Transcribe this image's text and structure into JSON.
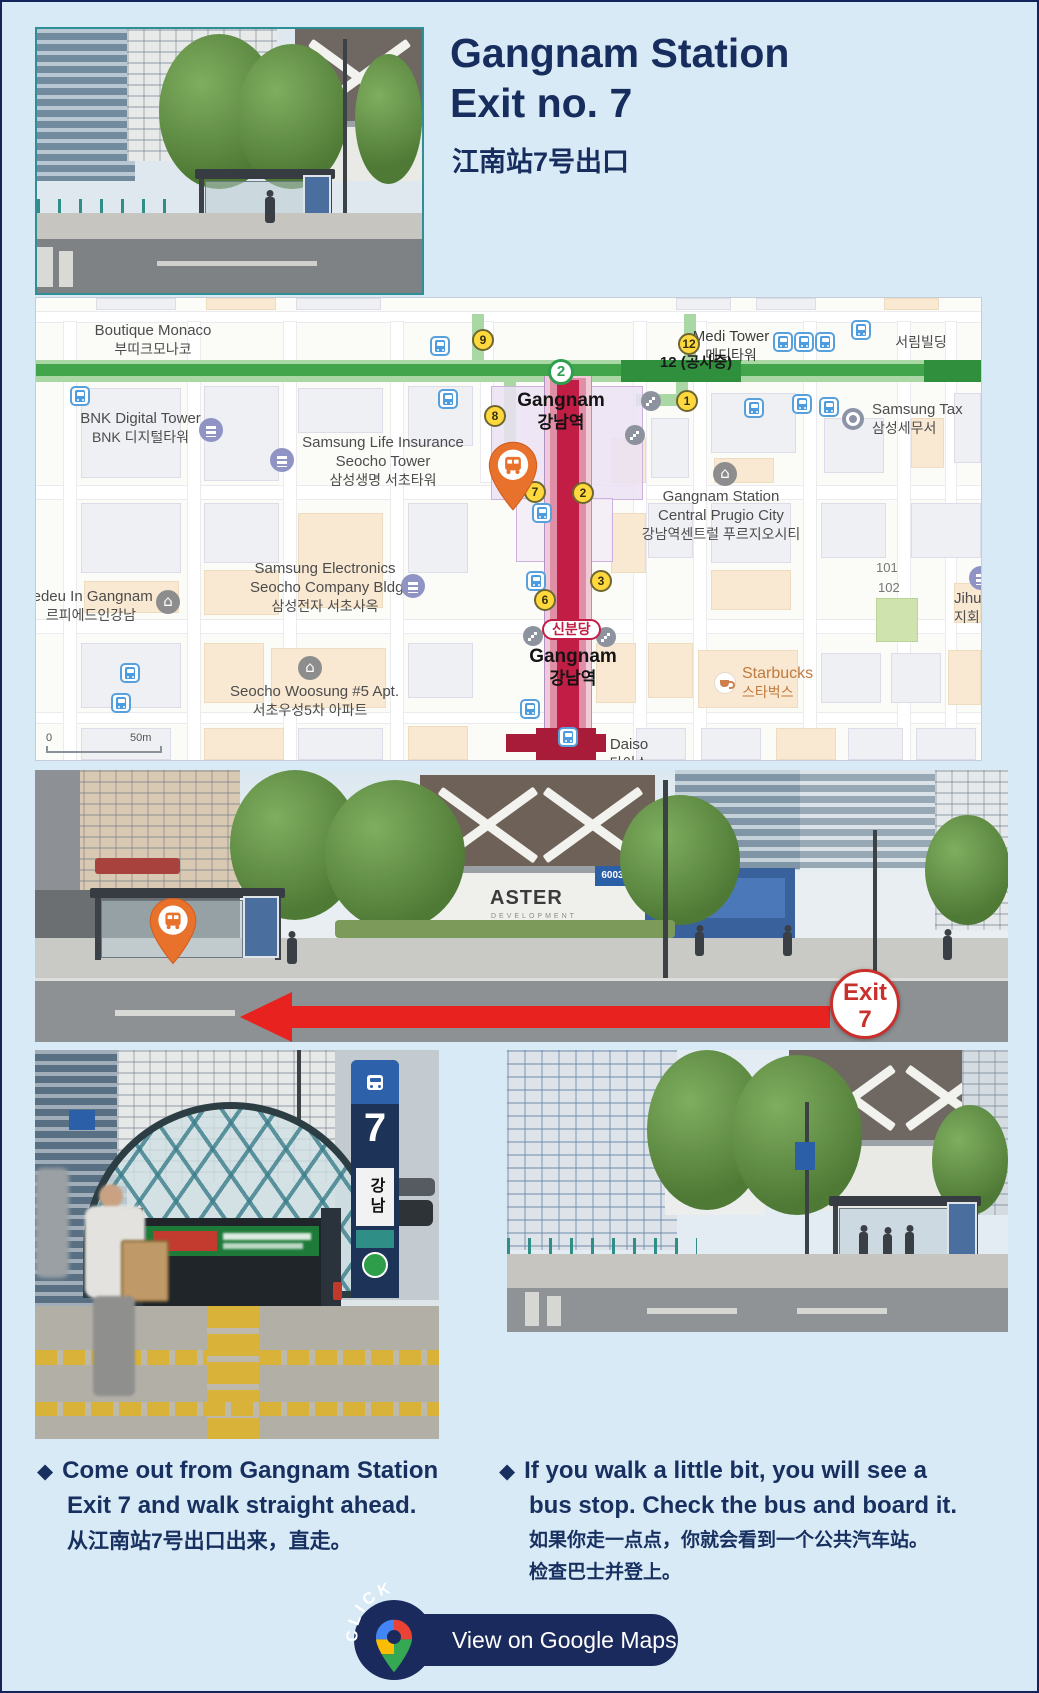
{
  "colors": {
    "background": "#d9eaf7",
    "navy": "#172d5e",
    "line2_green": "#42a54b",
    "sinbundang_red": "#c21d45",
    "exit_badge_yellow": "#ffd83d",
    "bus_pin_orange": "#e8712b",
    "arrow_red": "#e8231f",
    "cta_navy": "#1b2a5c"
  },
  "header": {
    "title_line1": "Gangnam Station",
    "title_line2": "Exit no. 7",
    "subtitle_zh": "江南站7号出口"
  },
  "map": {
    "places": {
      "boutique_monaco": {
        "en": "Boutique Monaco",
        "ko": "부띠크모나코"
      },
      "bnk_digital_tower": {
        "en": "BNK Digital Tower",
        "ko": "BNK 디지털타워"
      },
      "samsung_life": {
        "en1": "Samsung Life Insurance",
        "en2": "Seocho Tower",
        "ko": "삼성생명 서초타워"
      },
      "samsung_electronics": {
        "en1": "Samsung Electronics",
        "en2": "Seocho Company Bldg.",
        "ko": "삼성전자 서초사옥"
      },
      "lepiedeu_in_gangnam": {
        "en": "iedeu In Gangnam",
        "ko": "르피에드인강남"
      },
      "seocho_woosung": {
        "en": "Seocho Woosung #5 Apt.",
        "ko": "서초우성5차 아파트"
      },
      "gangnam_station_top": {
        "en": "Gangnam",
        "ko": "강남역"
      },
      "gangnam_station_bottom": {
        "en": "Gangnam",
        "ko": "강남역"
      },
      "medi_tower": {
        "en": "Medi Tower",
        "ko": "메디타워"
      },
      "construction_note": "12 (공사중)",
      "seorim_bldg": {
        "ko": "서림빌딩"
      },
      "samsung_tax": {
        "en": "Samsung Tax",
        "ko": "삼성세무서"
      },
      "central_prugio": {
        "en1": "Gangnam Station",
        "en2": "Central Prugio City",
        "ko": "강남역센트럴 푸르지오시티"
      },
      "building_101": "101",
      "building_102": "102",
      "jihui_bldg": {
        "en": "Jihui Bl",
        "ko": "지회빌"
      },
      "starbucks": {
        "en": "Starbucks",
        "ko": "스타벅스"
      },
      "daiso": {
        "en": "Daiso",
        "ko": "다이소"
      }
    },
    "badges": {
      "line2": "2",
      "sinbundang": "신분당"
    },
    "exit_numbers": [
      "9",
      "8",
      "12",
      "1",
      "7",
      "2",
      "3",
      "6"
    ],
    "scale": {
      "zero": "0",
      "fifty_m": "50m"
    }
  },
  "street_scene": {
    "exit_badge_word": "Exit",
    "exit_badge_number": "7",
    "construction_wall_title": "ASTER",
    "construction_wall_subtitle": "DEVELOPMENT",
    "bus_route_sign": "6003 5040"
  },
  "exit_entrance": {
    "pillar_number": "7",
    "pillar_station_ko": "강남"
  },
  "instructions": {
    "left": {
      "bullet": "◆",
      "en_line1": "Come out from Gangnam Station",
      "en_line2": "Exit 7 and walk straight ahead.",
      "zh": "从江南站7号出口出来，直走。"
    },
    "right": {
      "bullet": "◆",
      "en_line1": "If you walk a little bit, you will see a",
      "en_line2": "bus stop. Check the bus and board it.",
      "zh_line1": "如果你走一点点，你就会看到一个公共汽车站。",
      "zh_line2": "检查巴士并登上。"
    }
  },
  "cta": {
    "click_text": "CLICK",
    "button_label": "View on Google Maps"
  }
}
